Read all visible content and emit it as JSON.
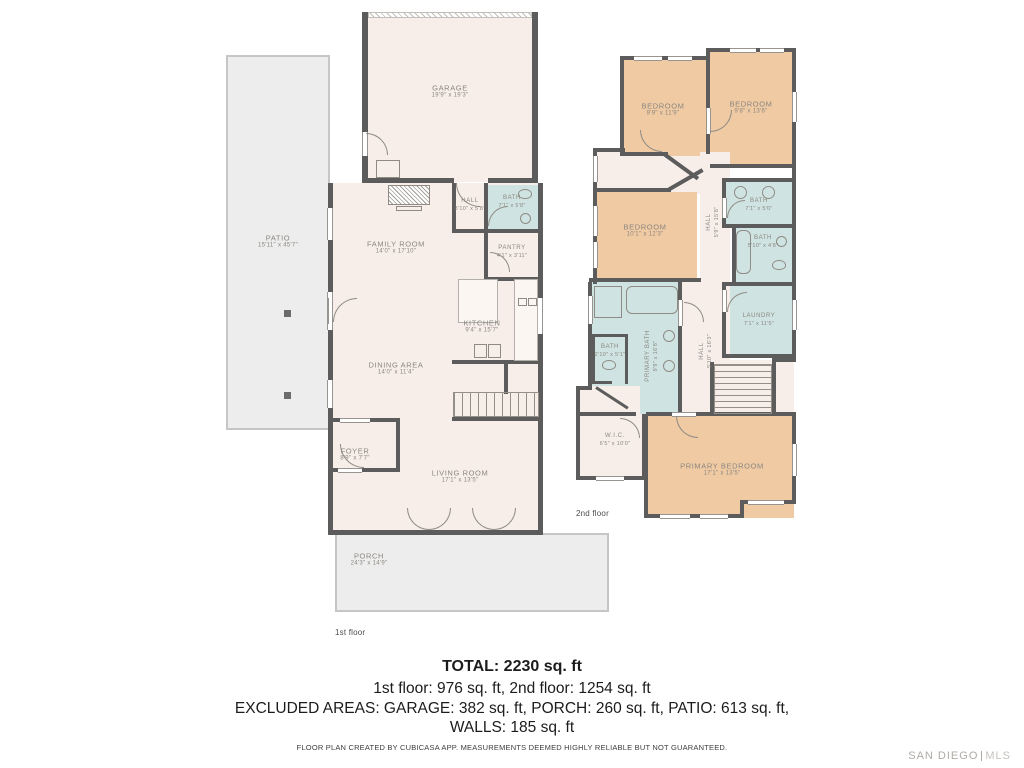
{
  "colors": {
    "wall": "#5c5c5c",
    "floor_interior": "#f7eee9",
    "bath_fill": "#cfe4e2",
    "bedroom_fill": "#efcaa3",
    "outdoor_fill": "#ededed",
    "outdoor_border": "#c6c6c6",
    "room_label": "#8b8680",
    "summary_text": "#1c1c1c",
    "logo_gray": "#aeaba7"
  },
  "floor1": {
    "caption": "1st floor",
    "rooms": [
      {
        "name": "PATIO",
        "dims": "15'11\" x 45'7\""
      },
      {
        "name": "GARAGE",
        "dims": "19'9\" x 19'3\""
      },
      {
        "name": "FAMILY ROOM",
        "dims": "14'0\" x 17'10\""
      },
      {
        "name": "HALL",
        "dims": "3'10\" x 5'8\""
      },
      {
        "name": "BATH",
        "dims": "7'1\" x 5'8\""
      },
      {
        "name": "PANTRY",
        "dims": "4'1\" x 3'11\""
      },
      {
        "name": "KITCHEN",
        "dims": "9'4\" x 15'7\""
      },
      {
        "name": "DINING AREA",
        "dims": "14'0\" x 11'4\""
      },
      {
        "name": "FOYER",
        "dims": "8'9\" x 7'7\""
      },
      {
        "name": "LIVING ROOM",
        "dims": "17'1\" x 13'5\""
      },
      {
        "name": "PORCH",
        "dims": "24'3\" x 14'9\""
      }
    ]
  },
  "floor2": {
    "caption": "2nd floor",
    "rooms": [
      {
        "name": "BEDROOM",
        "dims": "9'9\" x 11'9\""
      },
      {
        "name": "BEDROOM",
        "dims": "9'8\" x 13'6\""
      },
      {
        "name": "BEDROOM",
        "dims": "10'1\" x 12'3\""
      },
      {
        "name": "HALL",
        "dims": "5'9\" x 15'8\""
      },
      {
        "name": "BATH",
        "dims": "7'1\" x 5'0\""
      },
      {
        "name": "BATH",
        "dims": "5'10\" x 4'8\""
      },
      {
        "name": "LAUNDRY",
        "dims": "7'1\" x 11'5\""
      },
      {
        "name": "PRIMARY BATH",
        "dims": "9'9\" x 16'8\""
      },
      {
        "name": "BATH",
        "dims": "2'10\" x 5'1\""
      },
      {
        "name": "HALL",
        "dims": "5'10\" x 16'3\""
      },
      {
        "name": "W.I.C.",
        "dims": "6'5\" x 10'0\""
      },
      {
        "name": "PRIMARY BEDROOM",
        "dims": "17'1\" x 13'5\""
      }
    ]
  },
  "summary": {
    "total": "TOTAL: 2230 sq. ft",
    "floors_line": "1st floor: 976 sq. ft, 2nd floor: 1254 sq. ft",
    "excluded_line": "EXCLUDED AREAS: GARAGE: 382 sq. ft, PORCH: 260 sq. ft, PATIO: 613 sq. ft,",
    "walls_line": "WALLS: 185 sq. ft",
    "disclaimer": "FLOOR PLAN CREATED BY CUBICASA APP. MEASUREMENTS DEEMED HIGHLY RELIABLE BUT NOT GUARANTEED."
  },
  "branding": {
    "logo_left": "SAN DIEGO",
    "logo_right": "MLS"
  }
}
